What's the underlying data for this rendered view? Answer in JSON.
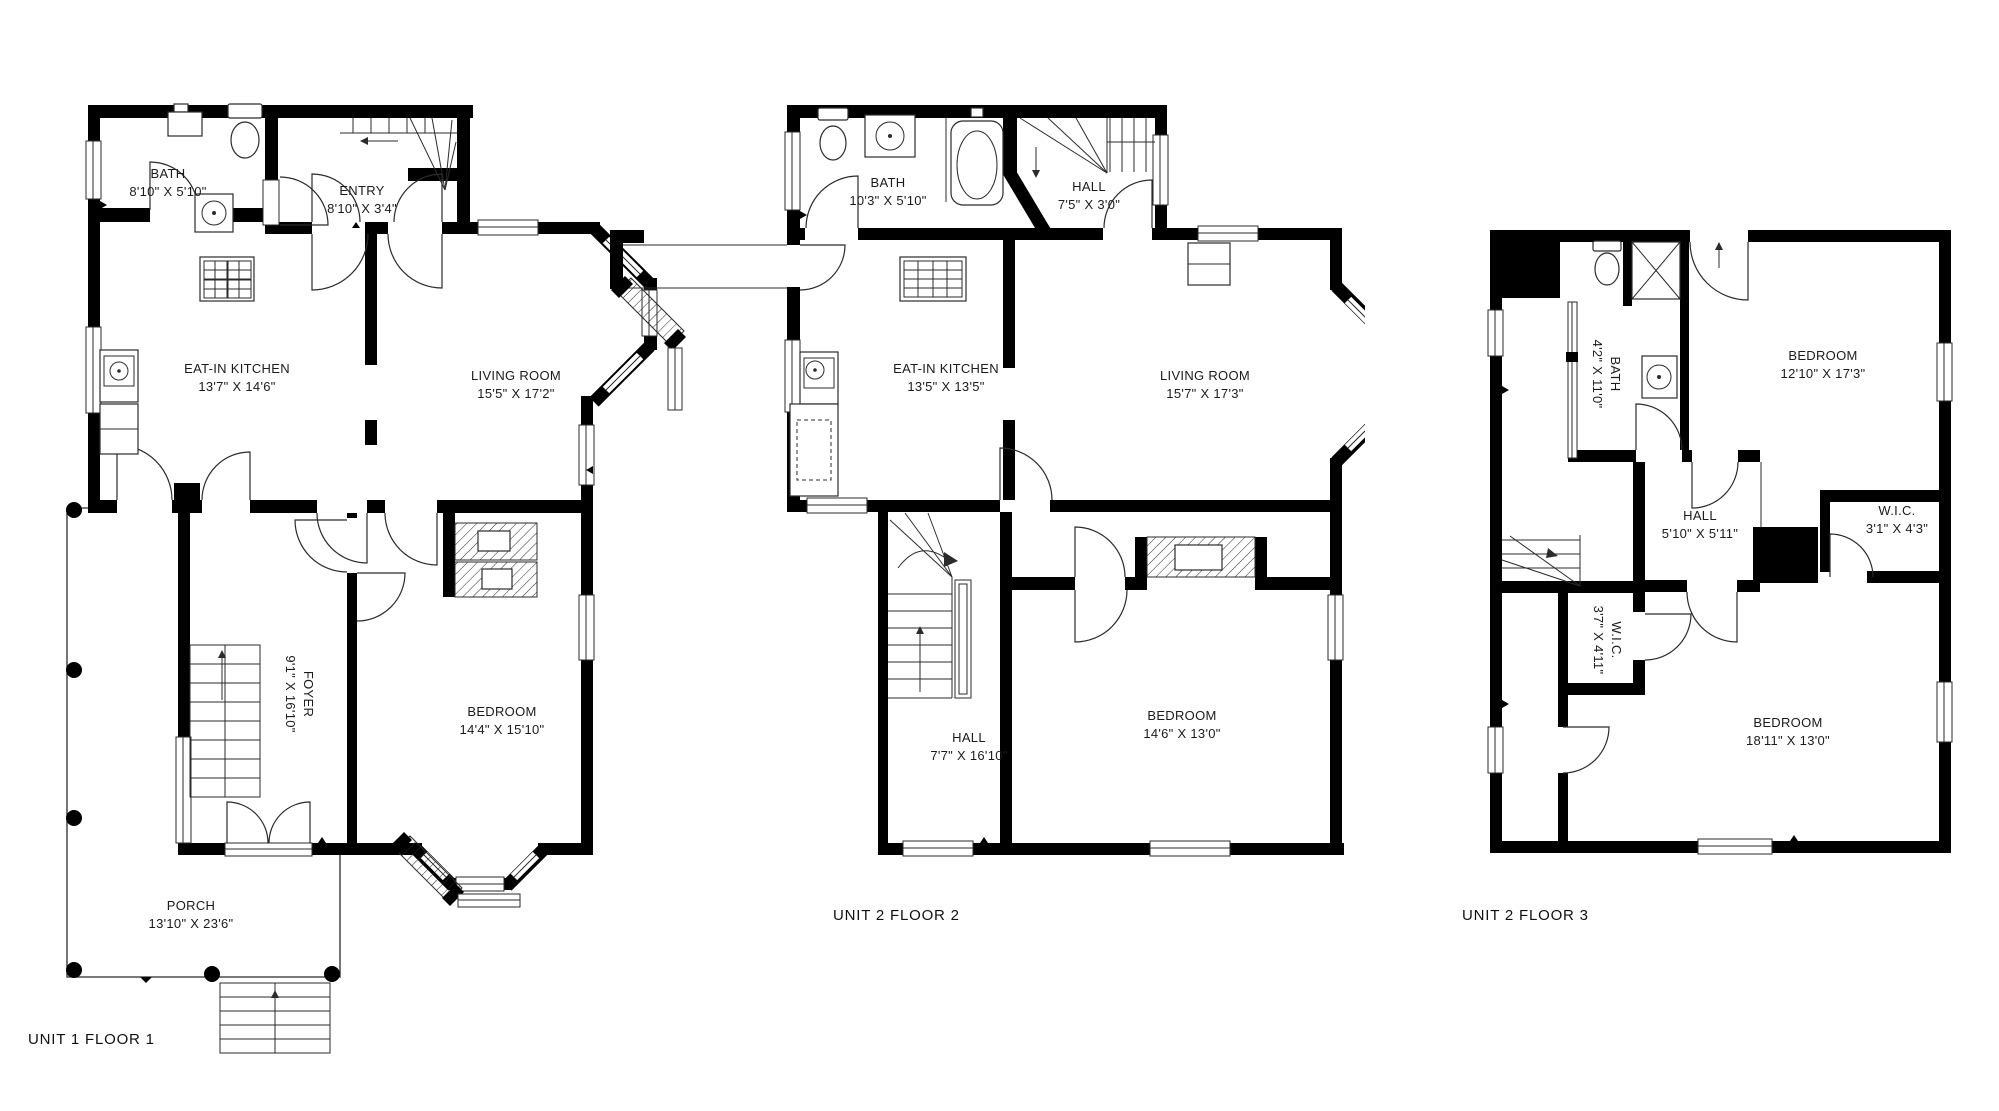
{
  "colors": {
    "wall": "#000000",
    "line": "#2b2b2b",
    "background": "#ffffff"
  },
  "plans": [
    {
      "title": "UNIT 1 FLOOR 1",
      "rooms": [
        {
          "name": "BATH",
          "dims": "8'10\" X 5'10\""
        },
        {
          "name": "ENTRY",
          "dims": "8'10\" X 3'4\""
        },
        {
          "name": "EAT-IN KITCHEN",
          "dims": "13'7\" X 14'6\""
        },
        {
          "name": "LIVING ROOM",
          "dims": "15'5\" X 17'2\""
        },
        {
          "name": "FOYER",
          "dims": "9'1\" X 16'10\""
        },
        {
          "name": "BEDROOM",
          "dims": "14'4\" X 15'10\""
        },
        {
          "name": "PORCH",
          "dims": "13'10\" X 23'6\""
        }
      ]
    },
    {
      "title": "UNIT 2 FLOOR 2",
      "rooms": [
        {
          "name": "BATH",
          "dims": "10'3\" X 5'10\""
        },
        {
          "name": "HALL",
          "dims": "7'5\" X 3'0\""
        },
        {
          "name": "EAT-IN KITCHEN",
          "dims": "13'5\" X 13'5\""
        },
        {
          "name": "LIVING ROOM",
          "dims": "15'7\" X 17'3\""
        },
        {
          "name": "HALL",
          "dims": "7'7\" X 16'10\""
        },
        {
          "name": "BEDROOM",
          "dims": "14'6\" X 13'0\""
        }
      ]
    },
    {
      "title": "UNIT 2 FLOOR 3",
      "rooms": [
        {
          "name": "BATH",
          "dims": "4'2\" X 11'0\""
        },
        {
          "name": "BEDROOM",
          "dims": "12'10\" X 17'3\""
        },
        {
          "name": "HALL",
          "dims": "5'10\" X 5'11\""
        },
        {
          "name": "W.I.C.",
          "dims": "3'1\" X 4'3\""
        },
        {
          "name": "W.I.C.",
          "dims": "3'7\" X 4'11\""
        },
        {
          "name": "BEDROOM",
          "dims": "18'11\" X 13'0\""
        }
      ]
    }
  ]
}
